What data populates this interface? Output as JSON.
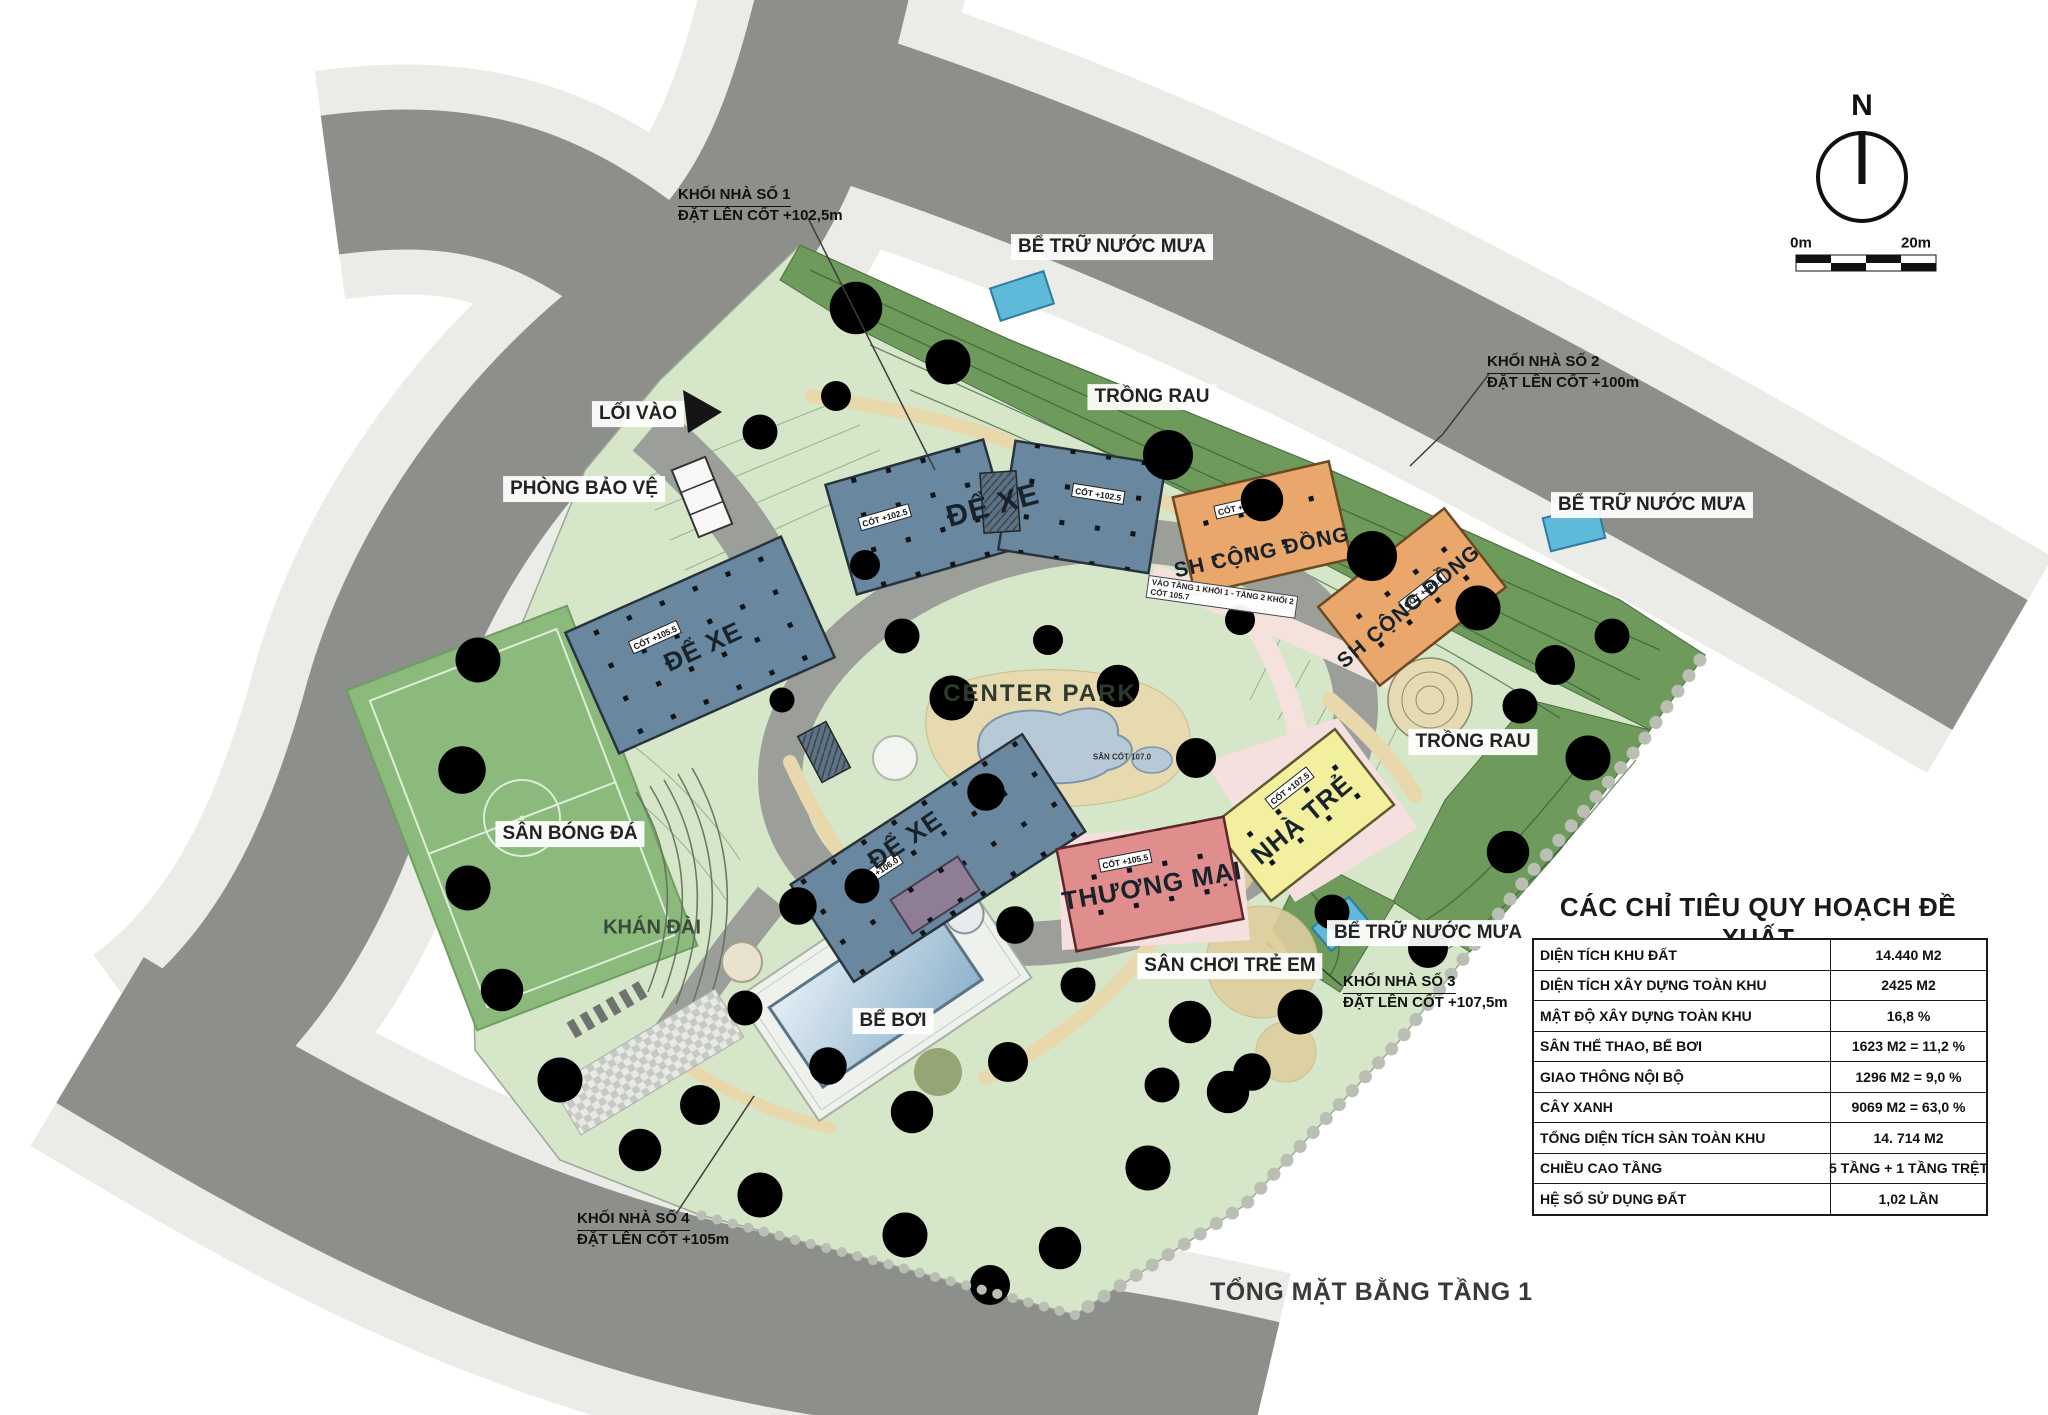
{
  "page_title": "TỔNG MẶT BẰNG TẦNG 1",
  "compass": {
    "north": "N",
    "scale_0": "0m",
    "scale_20": "20m"
  },
  "labels": {
    "loi_vao": "LỐI VÀO",
    "phong_bao_ve": "PHÒNG BẢO VỆ",
    "be_tru_nuoc_mua": "BỂ TRỮ NƯỚC MƯA",
    "trong_rau": "TRỒNG RAU",
    "center_park": "CENTER PARK",
    "san_bong_da": "SÂN BÓNG ĐÁ",
    "khan_dai": "KHÁN ĐÀI",
    "be_boi": "BỂ BƠI",
    "san_choi_tre_em": "SÂN CHƠI TRẺ EM",
    "de_xe": "ĐỂ XE",
    "sh_cong_dong": "SH CỘNG ĐỒNG",
    "thuong_mai": "THƯƠNG MẠI",
    "nha_tre": "NHÀ TRẺ",
    "san_cot": "SÂN CỐT 107.0"
  },
  "badges": {
    "cot_102_5": "CỐT +102.5",
    "cot_100": "CỐT +100.0",
    "cot_105_5": "CỐT +105.5",
    "cot_106": "CỐT +106.0",
    "cot_107_5": "CỐT +107.5",
    "vao_tang_line1": "VÀO TẦNG 1 KHỐI 1 - TẦNG 2 KHỐI 2",
    "vao_tang_line2": "CỐT 105.7"
  },
  "annotations": [
    {
      "line1": "KHỐI NHÀ SỐ 1",
      "line2": "ĐẶT LÊN CỐT +102,5m"
    },
    {
      "line1": "KHỐI NHÀ SỐ 2",
      "line2": "ĐẶT LÊN CỐT +100m"
    },
    {
      "line1": "KHỐI NHÀ SỐ 3",
      "line2": "ĐẶT LÊN CỐT +107,5m"
    },
    {
      "line1": "KHỐI NHÀ SỐ 4",
      "line2": "ĐẶT LÊN CỐT +105m"
    }
  ],
  "table": {
    "title": "CÁC CHỈ TIÊU QUY HOẠCH ĐỀ XUẤT",
    "rows": [
      {
        "label": "DIỆN TÍCH KHU ĐẤT",
        "value": "14.440 M2"
      },
      {
        "label": "DIỆN TÍCH XÂY DỰNG TOÀN KHU",
        "value": "2425 M2"
      },
      {
        "label": "MẬT ĐỘ XÂY DỰNG TOÀN KHU",
        "value": "16,8 %"
      },
      {
        "label": "SÂN THỂ THAO, BỂ BƠI",
        "value": "1623 M2 = 11,2 %"
      },
      {
        "label": "GIAO THÔNG NỘI BỘ",
        "value": "1296 M2 =  9,0 %"
      },
      {
        "label": "CÂY XANH",
        "value": "9069 M2 = 63,0 %"
      },
      {
        "label": "TỔNG DIỆN TÍCH SÀN  TOÀN KHU",
        "value": "14. 714 M2"
      },
      {
        "label": "CHIỀU CAO TẦNG",
        "value": "5 TẦNG + 1 TẦNG TRỆT"
      },
      {
        "label": "HỆ SỐ SỬ DỤNG ĐẤT",
        "value": "1,02 LẦN"
      }
    ]
  },
  "colors": {
    "road": "#8c8f8a",
    "sidewalk": "#ebece8",
    "site_green": "#d6e6c9",
    "band_green": "#6e9b5c",
    "building_blue": "#69889f",
    "building_orange": "#e9a76b",
    "building_pink": "#e08d8d",
    "building_yellow": "#f2ef9f",
    "water_tank": "#5fb9d9",
    "pond": "#b7c9d6",
    "path_tan": "#e9d9ac",
    "field_green": "#8cb97c"
  }
}
